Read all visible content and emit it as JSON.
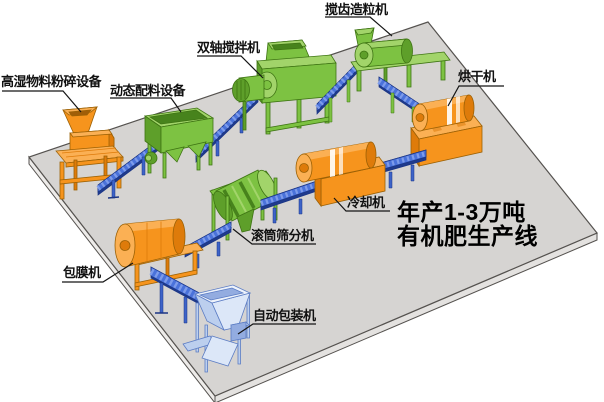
{
  "title": {
    "line1": "年产1-3万吨",
    "line2": "有机肥生产线"
  },
  "machine_labels": {
    "crusher": "高湿物料粉碎设备",
    "batcher": "动态配料设备",
    "mixer": "双轴搅拌机",
    "granulator": "搅齿造粒机",
    "dryer": "烘干机",
    "cooler": "冷却机",
    "screener": "滚筒筛分机",
    "coater": "包膜机",
    "packer": "自动包装机"
  },
  "process_flow": [
    "高湿物料粉碎设备",
    "动态配料设备",
    "双轴搅拌机",
    "搅齿造粒机",
    "烘干机",
    "冷却机",
    "滚筒筛分机",
    "包膜机",
    "自动包装机"
  ],
  "colors": {
    "machine_orange": "#F6941D",
    "machine_orange_dark": "#DE7B0A",
    "machine_orange_light": "#FBB054",
    "machine_green": "#7DC242",
    "machine_green_dark": "#5E9F2A",
    "conveyor_blue": "#3D63C8",
    "packer_light_blue": "#DCE7F8",
    "platform_gray": "#D6D4D2",
    "background": "#FFFFFF",
    "label_text": "#111111"
  }
}
